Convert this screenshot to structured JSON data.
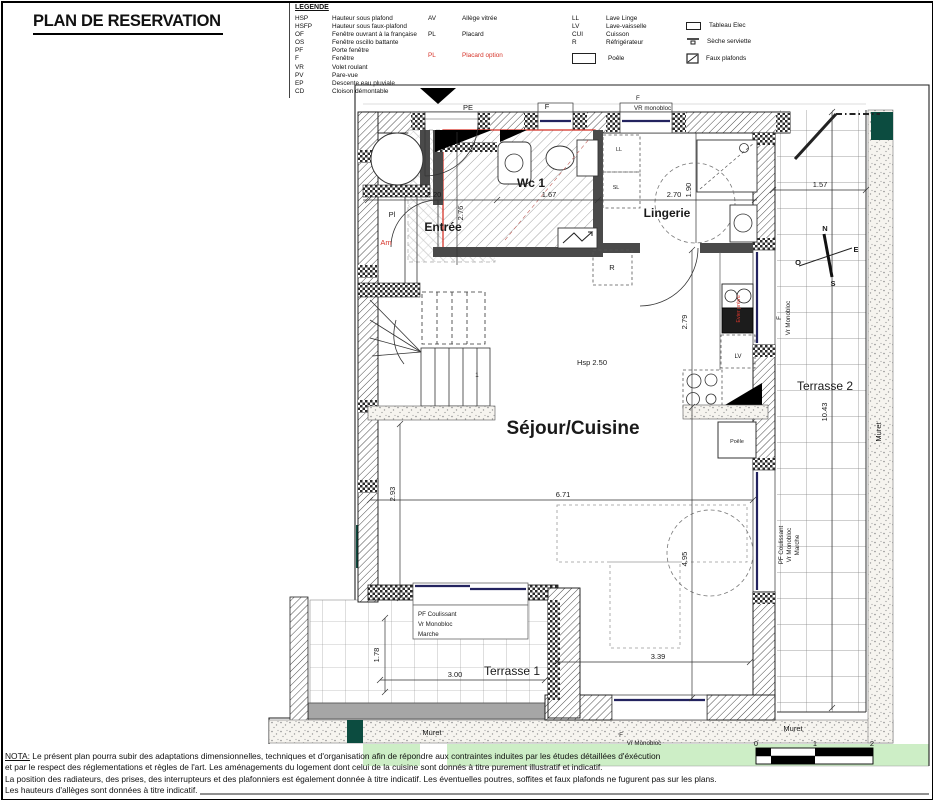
{
  "title": "PLAN DE RESERVATION",
  "legend": {
    "heading": "LEGENDE",
    "col1": [
      {
        "abbr": "HSP",
        "label": "Hauteur sous plafond"
      },
      {
        "abbr": "HSFP",
        "label": "Hauteur sous faux-plafond"
      },
      {
        "abbr": "OF",
        "label": "Fenêtre ouvrant à la française"
      },
      {
        "abbr": "OS",
        "label": "Fenêtre oscillo battante"
      },
      {
        "abbr": "PF",
        "label": "Porte fenêtre"
      },
      {
        "abbr": "F",
        "label": "Fenêtre"
      },
      {
        "abbr": "VR",
        "label": "Volet roulant"
      },
      {
        "abbr": "PV",
        "label": "Pare-vue"
      },
      {
        "abbr": "EP",
        "label": "Descente eau pluviale"
      },
      {
        "abbr": "CD",
        "label": "Cloison démontable"
      }
    ],
    "col2": [
      {
        "abbr": "AV",
        "label": "Allège vitrée"
      },
      {
        "abbr": "PL",
        "label": "Placard"
      },
      {
        "abbr": "PL",
        "label": "Placard option"
      }
    ],
    "col3": [
      {
        "abbr": "LL",
        "label": "Lave Linge"
      },
      {
        "abbr": "LV",
        "label": "Lave-vaisselle"
      },
      {
        "abbr": "CUI",
        "label": "Cuisson"
      },
      {
        "abbr": "R",
        "label": "Réfrigérateur"
      }
    ],
    "poele_label": "Poêle",
    "col4": [
      {
        "icon": "tableau-elec-icon",
        "label": "Tableau Elec"
      },
      {
        "icon": "seche-serviette-icon",
        "label": "Sèche serviette"
      },
      {
        "icon": "faux-plafonds-icon",
        "label": "Faux plafonds"
      }
    ]
  },
  "plan": {
    "top": {
      "pe": "PE",
      "f1": "F",
      "f2": "F",
      "vr": "VR monobloc"
    },
    "rooms": {
      "entree": "Entrée",
      "wc1": "Wc 1",
      "lingerie": "Lingerie",
      "sejour": "Séjour/Cuisine",
      "terrasse1": "Terrasse 1",
      "terrasse2": "Terrasse 2"
    },
    "labels": {
      "pl": "Pl",
      "am": "Am",
      "ll": "LL",
      "sl": "SL",
      "r": "R",
      "lv": "LV",
      "poele": "Poêle",
      "hsp": "Hsp 2.50",
      "stair_first": "1",
      "evier": "Evier prévu",
      "f_window_right": "F",
      "vr_window_right": "Vr Monobloc",
      "f_bottom": "F",
      "vr_bottom": "Vr Monobloc",
      "muret_bottom_left": "Muret",
      "muret_bottom_right": "Muret",
      "muret_right": "Muret"
    },
    "pf_lines": [
      "PF Coulissant",
      "Vr Monobloc",
      "Marche"
    ],
    "dims": {
      "d220": "2.20",
      "d167": "1.67",
      "d270": "2.70",
      "d276": "2.76",
      "d190": "1.90",
      "d157": "1.57",
      "d279": "2.79",
      "d293": "2.93",
      "d671": "6.71",
      "d1043": "10.43",
      "d495": "4.95",
      "d339": "3.39",
      "d300": "3.00",
      "d178": "1.78"
    },
    "compass": {
      "n": "N",
      "e": "E",
      "s": "S",
      "o": "O"
    },
    "scale": {
      "t0": "0",
      "t1": "1",
      "t2": "2"
    }
  },
  "nota": {
    "label": "NOTA:",
    "line1": "Le présent plan pourra subir des adaptations dimensionnelles, techniques et d'organisation afin de répondre aux contraintes induites par les études détaillées d'éxécution",
    "line2": "et par le respect des réglementations et règles de l'art. Les aménagements du logement dont celui de la cuisine sont donnés à titre purement illustratif et indicatif.",
    "line3": "La position des radiateurs, des prises, des interrupteurs et des plafonniers est également donnée à titre indicatif. Les éventuelles poutres, soffites et faux plafonds ne fugurent pas sur les plans.",
    "line4": "Les hauteurs d'allèges sont données à titre indicatif."
  },
  "colors": {
    "accent_red": "#d6352b",
    "glazing_navy": "#23235f",
    "teal": "#0c4c40",
    "green_band": "#cdeec6",
    "muret_gray": "#a6a6a6"
  }
}
